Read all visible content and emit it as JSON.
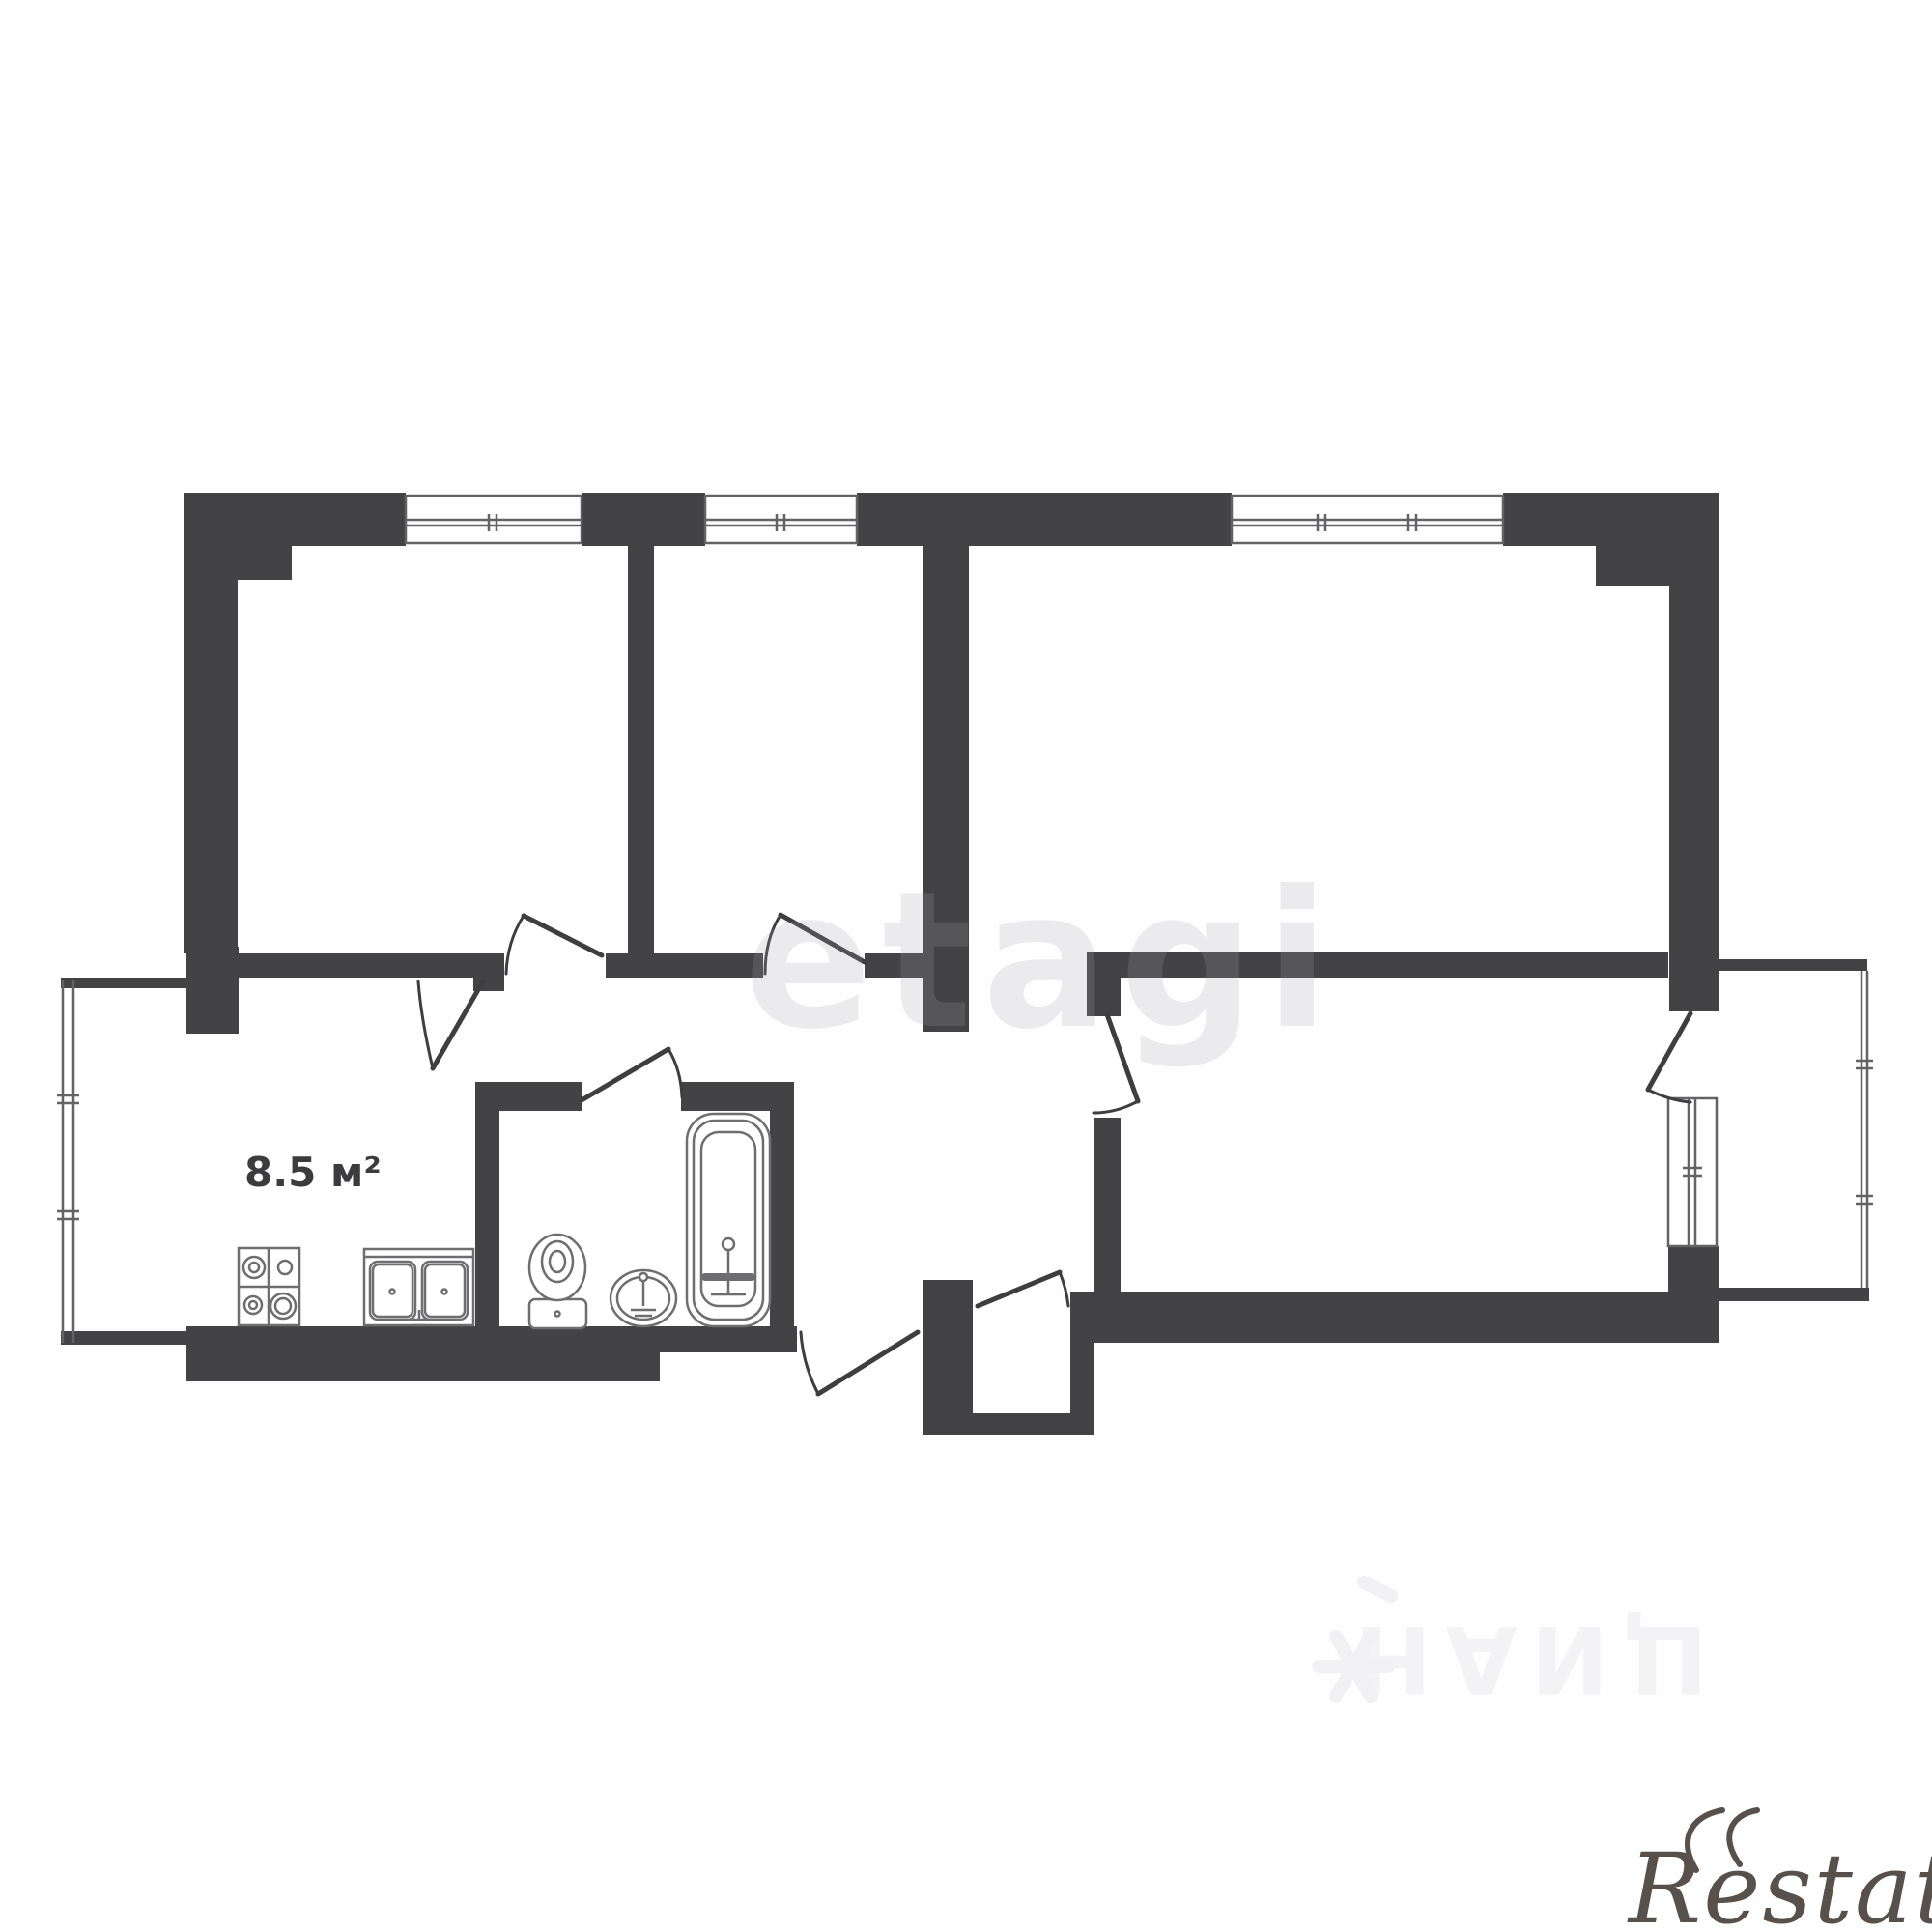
{
  "plan": {
    "type": "apartment-floor-plan",
    "labels": {
      "kitchen_area": "8.5 м²"
    },
    "rooms": [
      {
        "name": "room-left-top"
      },
      {
        "name": "room-middle-top"
      },
      {
        "name": "room-right-top"
      },
      {
        "name": "kitchen",
        "area_label": "8.5 м²"
      },
      {
        "name": "bathroom"
      },
      {
        "name": "hallway"
      },
      {
        "name": "room-right-bottom"
      },
      {
        "name": "balcony-right"
      },
      {
        "name": "entry-vestibule"
      }
    ],
    "fixtures": [
      "stove",
      "kitchen-sink",
      "toilet",
      "wash-basin",
      "bathtub"
    ],
    "colors": {
      "wall": "#434345",
      "line": "#636365",
      "fixture": "#6e6e70",
      "door": "#3e3e40",
      "label": "#3c3c3e",
      "watermark_etagi": "#e9e9ec",
      "watermark_cian": "#f2f2f4",
      "logo_restate": "#57504b",
      "background": "#fffeff"
    }
  },
  "watermarks": {
    "etagi": "etagi",
    "cian": "ЦИАН",
    "restate": "Restate"
  }
}
